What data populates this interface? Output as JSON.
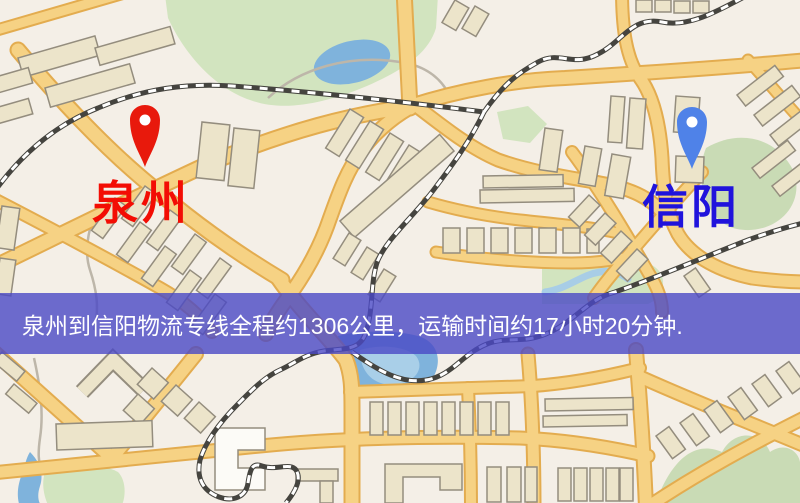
{
  "map": {
    "origin": {
      "label": "泉州",
      "pin_color": "#e8190c",
      "label_color": "#f30d04"
    },
    "destination": {
      "label": "信阳",
      "pin_color": "#4f82e8",
      "label_color": "#2013dc"
    },
    "banner": {
      "text": "泉州到信阳物流专线全程约1306公里，运输时间约17小时20分钟.",
      "background": "rgba(74,72,198,0.8)",
      "text_color": "#ffffff"
    },
    "route": {
      "distance_km": 1306,
      "duration_hours": 17,
      "duration_minutes": 20
    }
  }
}
